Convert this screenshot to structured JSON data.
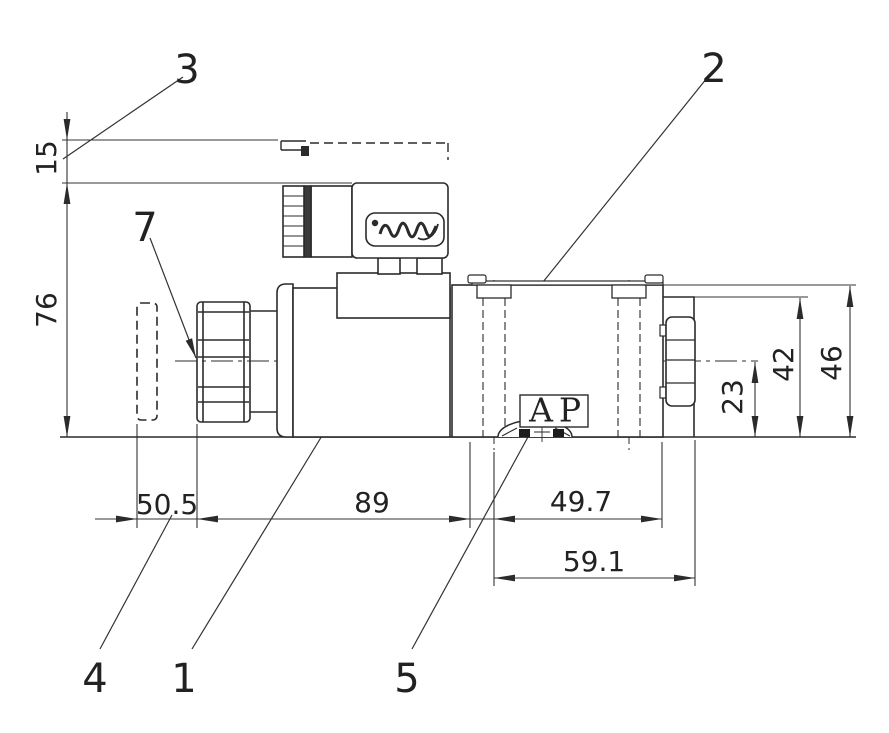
{
  "drawing": {
    "title": "solenoid-valve-outline-drawing",
    "callouts": {
      "c1": "1",
      "c2": "2",
      "c3": "3",
      "c4": "4",
      "c5": "5",
      "c7": "7"
    },
    "dims": {
      "d15": "15",
      "d76": "76",
      "d50_5": "50.5",
      "d89": "89",
      "d49_7": "49.7",
      "d59_1": "59.1",
      "d23": "23",
      "d42": "42",
      "d46": "46"
    },
    "ports": {
      "a": "A",
      "p": "P"
    },
    "colors": {
      "line": "#2b2b2b",
      "thin": "#333333",
      "background": "#ffffff"
    }
  }
}
